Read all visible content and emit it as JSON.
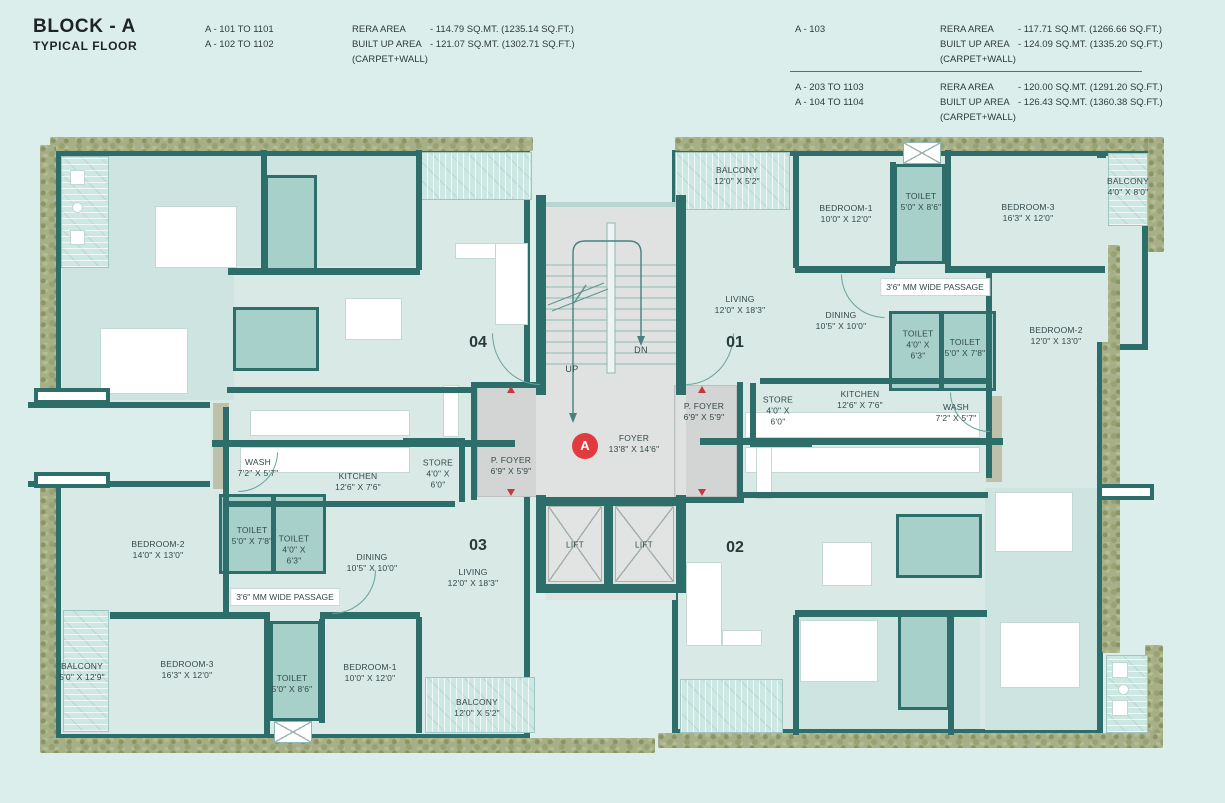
{
  "header": {
    "title": "BLOCK - A",
    "subtitle": "TYPICAL FLOOR",
    "left": {
      "units": [
        "A - 101 TO 1101",
        "A - 102 TO 1102"
      ],
      "rows": [
        {
          "label": "RERA AREA",
          "value": "- 114.79 SQ.MT. (1235.14 SQ.FT.)"
        },
        {
          "label": "BUILT UP AREA",
          "value": "- 121.07 SQ.MT. (1302.71 SQ.FT.)"
        },
        {
          "label": "(CARPET+WALL)",
          "value": ""
        }
      ]
    },
    "right_top": {
      "units": [
        "A - 103"
      ],
      "rows": [
        {
          "label": "RERA AREA",
          "value": "- 117.71 SQ.MT. (1266.66 SQ.FT.)"
        },
        {
          "label": "BUILT UP AREA",
          "value": "- 124.09 SQ.MT. (1335.20 SQ.FT.)"
        },
        {
          "label": "(CARPET+WALL)",
          "value": ""
        }
      ]
    },
    "right_bottom": {
      "units": [
        "A - 203 TO 1103",
        "A - 104 TO 1104"
      ],
      "rows": [
        {
          "label": "RERA AREA",
          "value": "- 120.00 SQ.MT. (1291.20 SQ.FT.)"
        },
        {
          "label": "BUILT UP AREA",
          "value": "- 126.43 SQ.MT. (1360.38 SQ.FT.)"
        },
        {
          "label": "(CARPET+WALL)",
          "value": ""
        }
      ]
    }
  },
  "block_badge": "A",
  "unit_numbers": {
    "u01": "01",
    "u02": "02",
    "u03": "03",
    "u04": "04"
  },
  "core": {
    "up": "UP",
    "dn": "DN",
    "lift": "LIFT",
    "foyer": {
      "n": "FOYER",
      "d": "13'8\" X 14'6\""
    },
    "pfoyer_left": {
      "n": "P. FOYER",
      "d": "6'9\" X 5'9\""
    },
    "pfoyer_right": {
      "n": "P. FOYER",
      "d": "6'9\" X 5'9\""
    }
  },
  "rooms": {
    "u1_balcony": {
      "n": "BALCONY",
      "d": "12'0\" X 5'2\""
    },
    "u1_bed1": {
      "n": "BEDROOM-1",
      "d": "10'0\" X 12'0\""
    },
    "u1_toilet1": {
      "n": "TOILET",
      "d": "5'0\" X 8'6\""
    },
    "u1_bed3": {
      "n": "BEDROOM-3",
      "d": "16'3\" X 12'0\""
    },
    "u1_balcony2": {
      "n": "BALCONY",
      "d": "4'0\" X 8'0\""
    },
    "u1_living": {
      "n": "LIVING",
      "d": "12'0\" X 18'3\""
    },
    "u1_dining": {
      "n": "DINING",
      "d": "10'5\" X 10'0\""
    },
    "u1_passage": {
      "n": "3'6\" MM WIDE PASSAGE"
    },
    "u1_toilet2": {
      "n": "TOILET",
      "d": "4'0\" X 6'3\""
    },
    "u1_toilet3": {
      "n": "TOILET",
      "d": "5'0\" X 7'8\""
    },
    "u1_bed2": {
      "n": "BEDROOM-2",
      "d": "12'0\" X 13'0\""
    },
    "u1_kitchen": {
      "n": "KITCHEN",
      "d": "12'6\" X 7'6\""
    },
    "u1_wash": {
      "n": "WASH",
      "d": "7'2\" X 5'7\""
    },
    "u1_store": {
      "n": "STORE",
      "d": "4'0\" X 6'0\""
    },
    "u3_wash": {
      "n": "WASH",
      "d": "7'2\" X 5'7\""
    },
    "u3_kitchen": {
      "n": "KITCHEN",
      "d": "12'6\" X 7'6\""
    },
    "u3_store": {
      "n": "STORE",
      "d": "4'0\" X 6'0\""
    },
    "u3_toilet1": {
      "n": "TOILET",
      "d": "5'0\" X 7'8\""
    },
    "u3_toilet2": {
      "n": "TOILET",
      "d": "4'0\" X 6'3\""
    },
    "u3_dining": {
      "n": "DINING",
      "d": "10'5\" X 10'0\""
    },
    "u3_bed2": {
      "n": "BEDROOM-2",
      "d": "14'0\" X 13'0\""
    },
    "u3_passage": {
      "n": "3'6\" MM WIDE PASSAGE"
    },
    "u3_living": {
      "n": "LIVING",
      "d": "12'0\" X 18'3\""
    },
    "u3_balcony1": {
      "n": "BALCONY",
      "d": "5'0\" X 12'9\""
    },
    "u3_bed3": {
      "n": "BEDROOM-3",
      "d": "16'3\" X 12'0\""
    },
    "u3_toilet3": {
      "n": "TOILET",
      "d": "5'0\" X 8'6\""
    },
    "u3_bed1": {
      "n": "BEDROOM-1",
      "d": "10'0\" X 12'0\""
    },
    "u3_balcony2": {
      "n": "BALCONY",
      "d": "12'0\" X 5'2\""
    }
  },
  "colors": {
    "wall": "#2d6d6a",
    "accent_red": "#e03c40",
    "toilet_fill": "#a7d0ca",
    "greenery": "#a6af87",
    "core_gray": "#e0e2e1",
    "background": "#dceeeb"
  }
}
